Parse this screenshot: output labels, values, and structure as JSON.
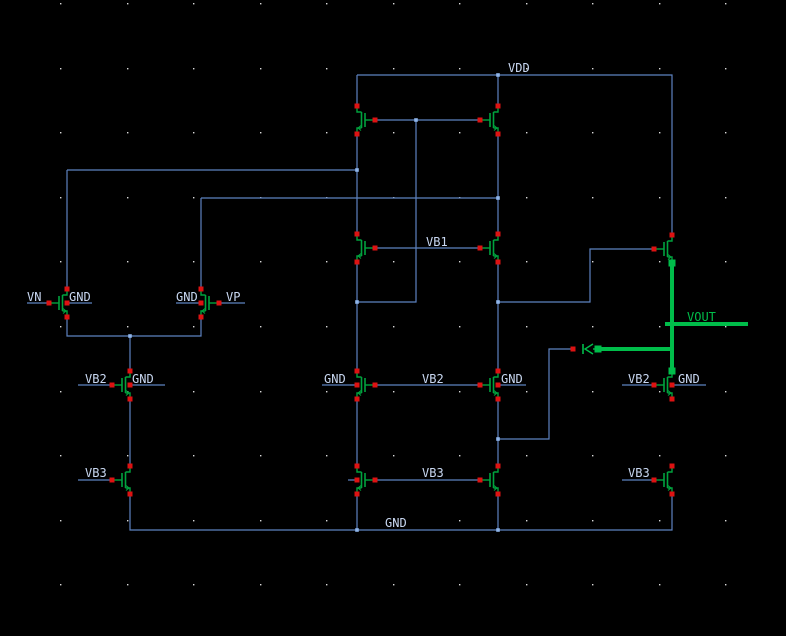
{
  "canvas": {
    "width": 786,
    "height": 636,
    "background": "#000000"
  },
  "palette": {
    "wire": "#5d82c0",
    "junction": "#8fb5ea",
    "terminal_red": "#dd1212",
    "device_green": "#00a33e",
    "highlight_green": "#00bd4a",
    "label_text": "#c9d8f2",
    "grid_dot": "#d9d9d9"
  },
  "grid": {
    "x_start": 60,
    "y_start": 3,
    "x_step": 66.5,
    "y_step": 64.6
  },
  "net_labels": [
    {
      "text": "VDD",
      "x": 508,
      "y": 72,
      "highlight": false
    },
    {
      "text": "VB1",
      "x": 426,
      "y": 246,
      "highlight": false
    },
    {
      "text": "VN",
      "x": 27,
      "y": 301,
      "highlight": false
    },
    {
      "text": "GND",
      "x": 69,
      "y": 301,
      "highlight": false
    },
    {
      "text": "GND",
      "x": 176,
      "y": 301,
      "highlight": false
    },
    {
      "text": "VP",
      "x": 226,
      "y": 301,
      "highlight": false
    },
    {
      "text": "VB2",
      "x": 85,
      "y": 383,
      "highlight": false
    },
    {
      "text": "GND",
      "x": 132,
      "y": 383,
      "highlight": false
    },
    {
      "text": "GND",
      "x": 324,
      "y": 383,
      "highlight": false
    },
    {
      "text": "VB2",
      "x": 422,
      "y": 383,
      "highlight": false
    },
    {
      "text": "GND",
      "x": 501,
      "y": 383,
      "highlight": false
    },
    {
      "text": "VB2",
      "x": 628,
      "y": 383,
      "highlight": false
    },
    {
      "text": "GND",
      "x": 678,
      "y": 383,
      "highlight": false
    },
    {
      "text": "VB3",
      "x": 85,
      "y": 477,
      "highlight": false
    },
    {
      "text": "VB3",
      "x": 422,
      "y": 477,
      "highlight": false
    },
    {
      "text": "VB3",
      "x": 628,
      "y": 477,
      "highlight": false
    },
    {
      "text": "GND",
      "x": 385,
      "y": 527,
      "highlight": false
    },
    {
      "text": "VOUT",
      "x": 687,
      "y": 321,
      "highlight": true
    }
  ],
  "wires": [
    {
      "pts": [
        [
          357,
          75
        ],
        [
          672,
          75
        ],
        [
          672,
          235
        ]
      ]
    },
    {
      "pts": [
        [
          357,
          75
        ],
        [
          357,
          106
        ]
      ]
    },
    {
      "pts": [
        [
          498,
          75
        ],
        [
          498,
          106
        ]
      ]
    },
    {
      "pts": [
        [
          375,
          120
        ],
        [
          480,
          120
        ]
      ]
    },
    {
      "pts": [
        [
          416,
          120
        ],
        [
          416,
          302
        ],
        [
          357,
          302
        ]
      ]
    },
    {
      "pts": [
        [
          357,
          134
        ],
        [
          357,
          234
        ]
      ]
    },
    {
      "pts": [
        [
          357,
          262
        ],
        [
          357,
          371
        ]
      ]
    },
    {
      "pts": [
        [
          357,
          399
        ],
        [
          357,
          466
        ]
      ]
    },
    {
      "pts": [
        [
          357,
          494
        ],
        [
          357,
          530
        ]
      ]
    },
    {
      "pts": [
        [
          498,
          134
        ],
        [
          498,
          234
        ]
      ]
    },
    {
      "pts": [
        [
          498,
          262
        ],
        [
          498,
          371
        ]
      ]
    },
    {
      "pts": [
        [
          498,
          399
        ],
        [
          498,
          466
        ]
      ]
    },
    {
      "pts": [
        [
          498,
          494
        ],
        [
          498,
          530
        ]
      ]
    },
    {
      "pts": [
        [
          67,
          170
        ],
        [
          357,
          170
        ]
      ]
    },
    {
      "pts": [
        [
          67,
          170
        ],
        [
          67,
          289
        ]
      ]
    },
    {
      "pts": [
        [
          201,
          198
        ],
        [
          498,
          198
        ]
      ]
    },
    {
      "pts": [
        [
          201,
          198
        ],
        [
          201,
          289
        ]
      ]
    },
    {
      "pts": [
        [
          67,
          317
        ],
        [
          67,
          336
        ],
        [
          201,
          336
        ],
        [
          201,
          317
        ]
      ]
    },
    {
      "pts": [
        [
          130,
          336
        ],
        [
          130,
          371
        ]
      ]
    },
    {
      "pts": [
        [
          130,
          399
        ],
        [
          130,
          466
        ]
      ]
    },
    {
      "pts": [
        [
          130,
          494
        ],
        [
          130,
          530
        ],
        [
          672,
          530
        ],
        [
          672,
          494
        ]
      ]
    },
    {
      "pts": [
        [
          375,
          248
        ],
        [
          480,
          248
        ]
      ]
    },
    {
      "pts": [
        [
          375,
          385
        ],
        [
          480,
          385
        ]
      ]
    },
    {
      "pts": [
        [
          375,
          480
        ],
        [
          480,
          480
        ]
      ]
    },
    {
      "pts": [
        [
          498,
          302
        ],
        [
          590,
          302
        ],
        [
          590,
          249
        ],
        [
          654,
          249
        ]
      ]
    },
    {
      "pts": [
        [
          498,
          439
        ],
        [
          549,
          439
        ],
        [
          549,
          349
        ],
        [
          573,
          349
        ]
      ]
    },
    {
      "pts": [
        [
          27,
          303
        ],
        [
          49,
          303
        ]
      ]
    },
    {
      "pts": [
        [
          219,
          303
        ],
        [
          245,
          303
        ]
      ]
    },
    {
      "pts": [
        [
          67,
          303
        ],
        [
          92,
          303
        ]
      ]
    },
    {
      "pts": [
        [
          176,
          303
        ],
        [
          201,
          303
        ]
      ]
    },
    {
      "pts": [
        [
          78,
          385
        ],
        [
          112,
          385
        ]
      ]
    },
    {
      "pts": [
        [
          130,
          385
        ],
        [
          165,
          385
        ]
      ]
    },
    {
      "pts": [
        [
          322,
          385
        ],
        [
          357,
          385
        ]
      ]
    },
    {
      "pts": [
        [
          498,
          385
        ],
        [
          526,
          385
        ]
      ]
    },
    {
      "pts": [
        [
          622,
          385
        ],
        [
          654,
          385
        ]
      ]
    },
    {
      "pts": [
        [
          672,
          385
        ],
        [
          706,
          385
        ]
      ]
    },
    {
      "pts": [
        [
          78,
          480
        ],
        [
          112,
          480
        ]
      ]
    },
    {
      "pts": [
        [
          622,
          480
        ],
        [
          654,
          480
        ]
      ]
    },
    {
      "pts": [
        [
          348,
          480
        ],
        [
          357,
          480
        ]
      ]
    }
  ],
  "junctions": [
    [
      498,
      75
    ],
    [
      416,
      120
    ],
    [
      357,
      170
    ],
    [
      498,
      198
    ],
    [
      357,
      302
    ],
    [
      498,
      302
    ],
    [
      130,
      336
    ],
    [
      498,
      439
    ],
    [
      357,
      530
    ],
    [
      498,
      530
    ]
  ],
  "transistors": [
    {
      "name": "pmos-load-left",
      "x": 357,
      "y": 120,
      "gate": "right",
      "bulk_stub_to": null,
      "sel": null
    },
    {
      "name": "pmos-load-right",
      "x": 498,
      "y": 120,
      "gate": "left",
      "bulk_stub_to": null,
      "sel": null
    },
    {
      "name": "nmos-cascode-left",
      "x": 357,
      "y": 248,
      "gate": "right",
      "bulk_stub_to": null,
      "sel": null
    },
    {
      "name": "nmos-cascode-right",
      "x": 498,
      "y": 248,
      "gate": "left",
      "bulk_stub_to": null,
      "sel": null
    },
    {
      "name": "nmos-input-vn",
      "x": 67,
      "y": 303,
      "gate": "left",
      "bulk_stub_to": 92,
      "sel": null
    },
    {
      "name": "nmos-input-vp",
      "x": 201,
      "y": 303,
      "gate": "right",
      "bulk_stub_to": 176,
      "sel": null
    },
    {
      "name": "nmos-tail-vb2",
      "x": 130,
      "y": 385,
      "gate": "left",
      "bulk_stub_to": 165,
      "sel": null
    },
    {
      "name": "nmos-vb2-center-left",
      "x": 357,
      "y": 385,
      "gate": "right",
      "bulk_stub_to": 350,
      "sel": null
    },
    {
      "name": "nmos-vb2-center-right",
      "x": 498,
      "y": 385,
      "gate": "left",
      "bulk_stub_to": 526,
      "sel": null
    },
    {
      "name": "nmos-vb2-output",
      "x": 672,
      "y": 385,
      "gate": "left",
      "bulk_stub_to": 706,
      "sel": "top"
    },
    {
      "name": "nmos-vb3-left",
      "x": 130,
      "y": 480,
      "gate": "left",
      "bulk_stub_to": null,
      "sel": null
    },
    {
      "name": "nmos-vb3-center-left",
      "x": 357,
      "y": 480,
      "gate": "right",
      "bulk_stub_to": 350,
      "sel": null
    },
    {
      "name": "nmos-vb3-center-right",
      "x": 498,
      "y": 480,
      "gate": "left",
      "bulk_stub_to": null,
      "sel": null
    },
    {
      "name": "nmos-vb3-output",
      "x": 672,
      "y": 480,
      "gate": "left",
      "bulk_stub_to": null,
      "sel": null
    },
    {
      "name": "pmos-output",
      "x": 672,
      "y": 249,
      "gate": "left",
      "bulk_stub_to": null,
      "sel": "bottom"
    }
  ],
  "highlight_net": {
    "name": "VOUT",
    "wires": [
      {
        "pts": [
          [
            672,
            263
          ],
          [
            672,
            371
          ]
        ]
      },
      {
        "pts": [
          [
            665,
            324
          ],
          [
            748,
            324
          ]
        ]
      },
      {
        "pts": [
          [
            598,
            349
          ],
          [
            672,
            349
          ]
        ]
      }
    ],
    "squares": [
      [
        672,
        263
      ],
      [
        672,
        371
      ],
      [
        598,
        349
      ]
    ]
  },
  "compensation_device": {
    "red_terminal": [
      573,
      349
    ],
    "plate_bar": [
      [
        583,
        344
      ],
      [
        583,
        354
      ]
    ],
    "chevron": {
      "apex": [
        585,
        349
      ],
      "end1": [
        593,
        344
      ],
      "end2": [
        593,
        354
      ]
    },
    "lead": [
      [
        593,
        349
      ],
      [
        598,
        349
      ]
    ],
    "green_terminal": [
      598,
      349
    ]
  }
}
